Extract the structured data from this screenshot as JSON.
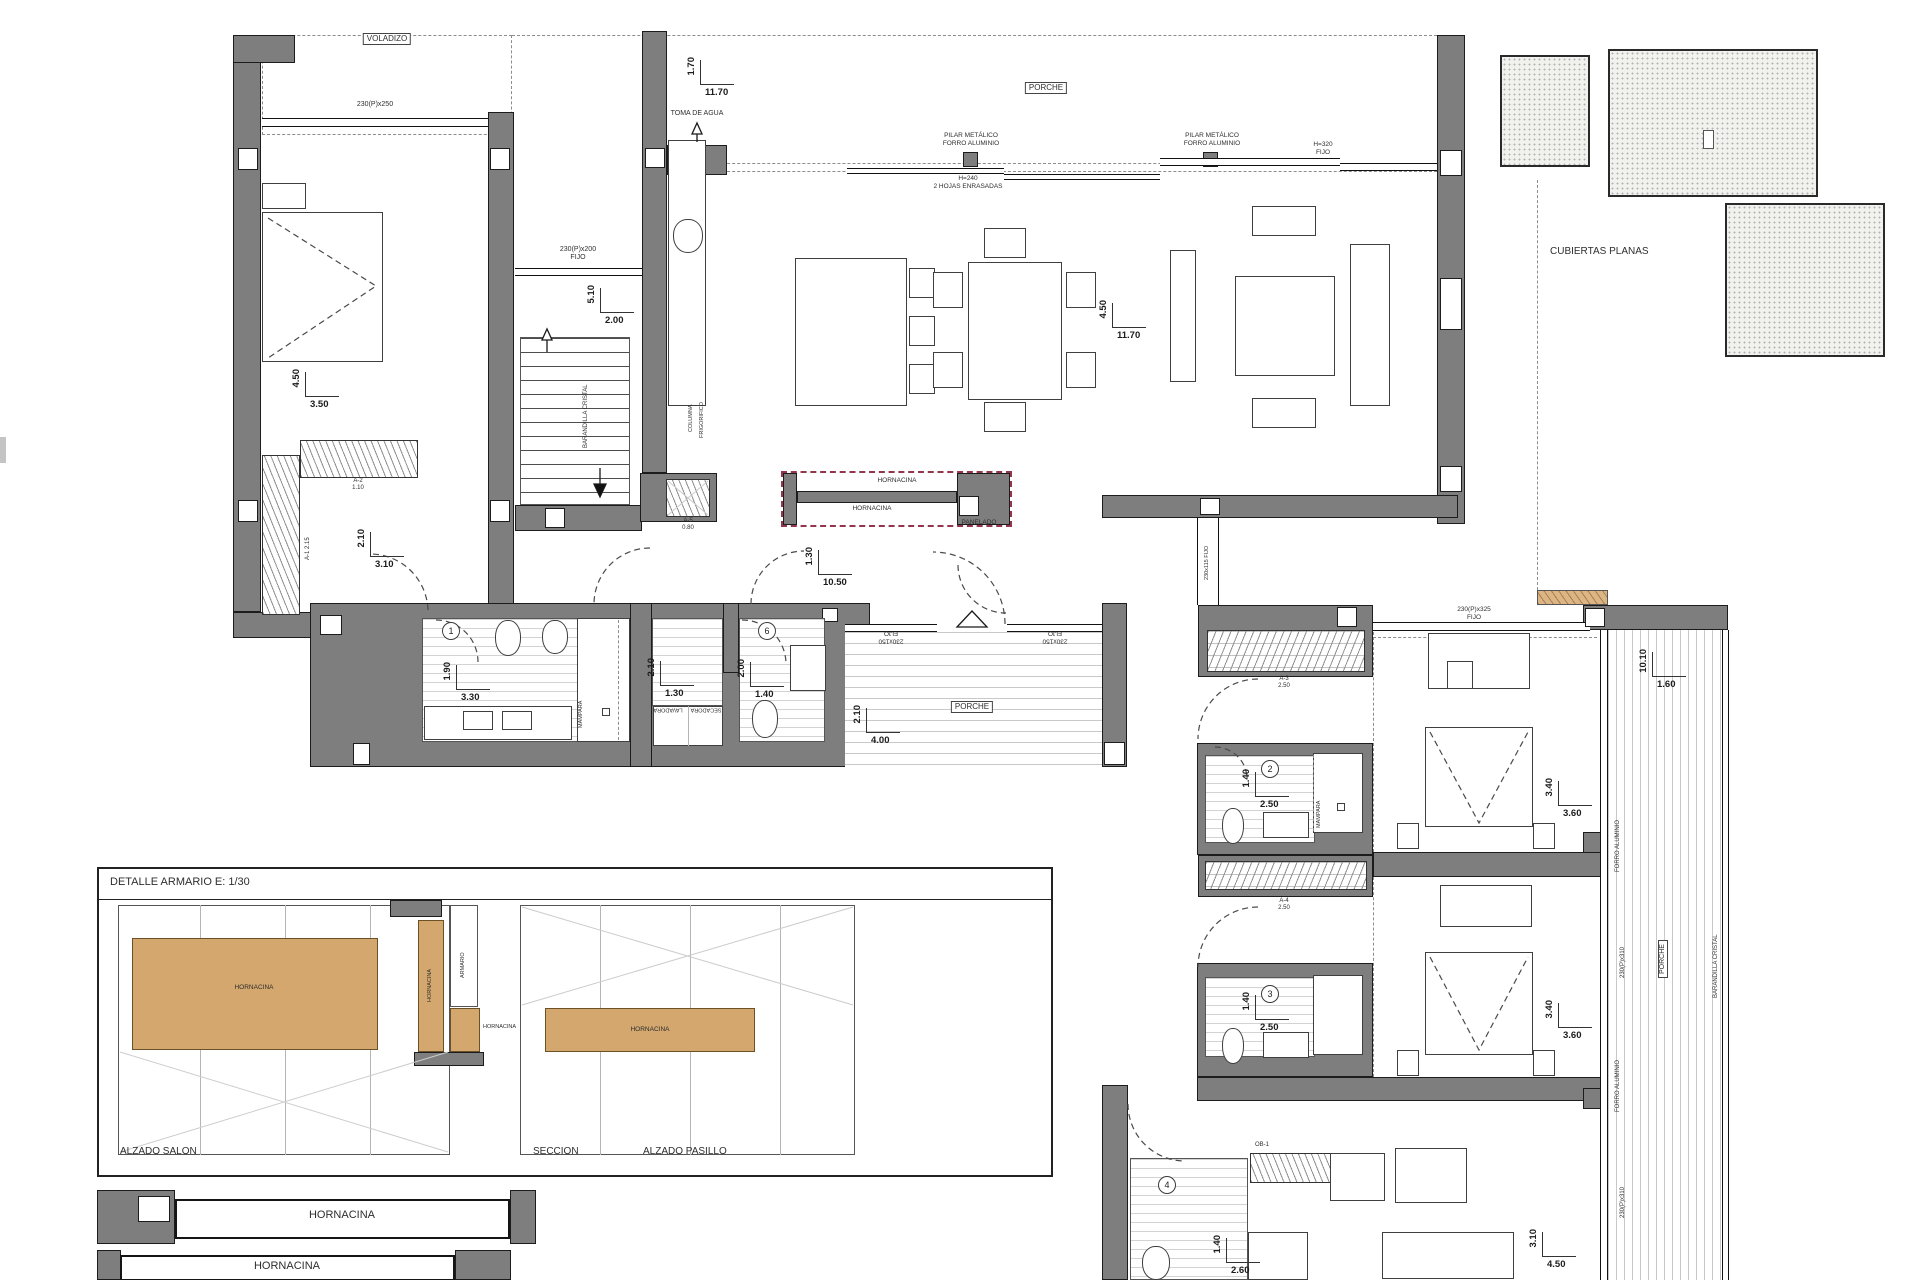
{
  "document": {
    "kind": "architectural floor plan (planta de vivienda) with roof inset and cabinet detail",
    "language": "es"
  },
  "colors": {
    "wall_fill": "#7e7e7e",
    "line": "#1c1c1c",
    "hornacina_highlight": "#93354c",
    "wood_panel": "#d3a76d",
    "stone_hatch": "#ddb584",
    "paper": "#ffffff"
  },
  "annotations": [
    {
      "id": "voladizo",
      "t": "VOLADIZO",
      "x": 387,
      "y": 33,
      "c": 1,
      "b": 1,
      "s": 8
    },
    {
      "id": "win-230p250",
      "t": "230(P)x250",
      "x": 375,
      "y": 101,
      "c": 1,
      "s": 7
    },
    {
      "id": "win-230p200",
      "t": "230(P)x200\nFIJO",
      "x": 578,
      "y": 246,
      "c": 1,
      "s": 7
    },
    {
      "id": "toma-de-agua",
      "t": "TOMA DE AGUA",
      "x": 697,
      "y": 110,
      "c": 1,
      "s": 7
    },
    {
      "id": "porche-top",
      "t": "PORCHE",
      "x": 1046,
      "y": 82,
      "c": 1,
      "b": 1,
      "s": 8
    },
    {
      "id": "pilar-metalico-1",
      "t": "PILAR METÁLICO\nFORRO ALUMINIO",
      "x": 971,
      "y": 132,
      "c": 1,
      "s": 6.5
    },
    {
      "id": "pilar-metalico-2",
      "t": "PILAR METÁLICO\nFORRO ALUMINIO",
      "x": 1212,
      "y": 132,
      "c": 1,
      "s": 6.5
    },
    {
      "id": "win-h320",
      "t": "H=320\nFIJO",
      "x": 1323,
      "y": 141,
      "c": 1,
      "s": 6.5
    },
    {
      "id": "win-h240",
      "t": "H=240\n2 HOJAS ENRASADAS",
      "x": 968,
      "y": 175,
      "c": 1,
      "s": 6.5
    },
    {
      "id": "hornacina-plan-top",
      "t": "HORNACINA",
      "x": 897,
      "y": 477,
      "c": 1,
      "s": 6.5
    },
    {
      "id": "hornacina-plan-bot",
      "t": "HORNACINA",
      "x": 872,
      "y": 505,
      "c": 1,
      "s": 6.5
    },
    {
      "id": "panelado",
      "t": "PANELADO",
      "x": 979,
      "y": 519,
      "c": 1,
      "s": 6.5
    },
    {
      "id": "armario-a5",
      "t": "A-5\n0.80",
      "x": 688,
      "y": 518,
      "c": 1,
      "s": 6
    },
    {
      "id": "armario-a2",
      "t": "A-2\n1.10",
      "x": 358,
      "y": 478,
      "c": 1,
      "s": 6
    },
    {
      "id": "armario-a1",
      "t": "A-1 2.15",
      "x": 305,
      "y": 560,
      "r": -90,
      "s": 6
    },
    {
      "id": "barandilla-escalera",
      "t": "BARANDILLA CRISTAL",
      "x": 583,
      "y": 448,
      "r": -90,
      "s": 6
    },
    {
      "id": "columna",
      "t": "COLUMNA",
      "x": 688,
      "y": 432,
      "r": -90,
      "s": 5.5
    },
    {
      "id": "frigorifico",
      "t": "FRIGORIFICO",
      "x": 699,
      "y": 438,
      "r": -90,
      "s": 5.5
    },
    {
      "id": "win-230x150-a",
      "t": "230x150\nFIJO",
      "x": 891,
      "y": 629,
      "c": 1,
      "r": 180,
      "s": 6.5
    },
    {
      "id": "win-230x150-b",
      "t": "230x150\nFIJO",
      "x": 1055,
      "y": 629,
      "c": 1,
      "r": 180,
      "s": 6.5
    },
    {
      "id": "porche-centro",
      "t": "PORCHE",
      "x": 972,
      "y": 701,
      "c": 1,
      "b": 1,
      "s": 8
    },
    {
      "id": "mampara-1",
      "t": "MAMPARA",
      "x": 578,
      "y": 728,
      "r": -90,
      "s": 5.5
    },
    {
      "id": "lavadora",
      "t": "LAVADORA",
      "x": 668,
      "y": 706,
      "c": 1,
      "r": 180,
      "s": 5.5
    },
    {
      "id": "secadora",
      "t": "SECADORA",
      "x": 706,
      "y": 706,
      "c": 1,
      "r": 180,
      "s": 5.5
    },
    {
      "id": "win-230x115",
      "t": "230x115 FIJO",
      "x": 1204,
      "y": 580,
      "r": -90,
      "s": 5.5
    },
    {
      "id": "armario-a3",
      "t": "A-3\n2.50",
      "x": 1284,
      "y": 676,
      "c": 1,
      "s": 6
    },
    {
      "id": "win-230p325",
      "t": "230(P)x325\nFIJO",
      "x": 1474,
      "y": 606,
      "c": 1,
      "s": 6.5
    },
    {
      "id": "mampara-2",
      "t": "MAMPARA",
      "x": 1316,
      "y": 828,
      "r": -90,
      "s": 5.5
    },
    {
      "id": "armario-a4",
      "t": "A-4\n2.50",
      "x": 1284,
      "y": 898,
      "c": 1,
      "s": 6
    },
    {
      "id": "forro-aluminio-1",
      "t": "FORRO ALUMINIO",
      "x": 1615,
      "y": 872,
      "r": -90,
      "s": 6
    },
    {
      "id": "forro-aluminio-2",
      "t": "FORRO ALUMINIO",
      "x": 1615,
      "y": 1112,
      "r": -90,
      "s": 6
    },
    {
      "id": "win-230p310-a",
      "t": "230(P)x310",
      "x": 1620,
      "y": 978,
      "r": -90,
      "s": 6
    },
    {
      "id": "win-230p310-b",
      "t": "230(P)x310",
      "x": 1620,
      "y": 1218,
      "r": -90,
      "s": 6
    },
    {
      "id": "porche-terraza",
      "t": "PORCHE",
      "x": 1658,
      "y": 978,
      "r": -90,
      "b": 1,
      "s": 7
    },
    {
      "id": "barandilla-terraza",
      "t": "BARANDILLA CRISTAL",
      "x": 1713,
      "y": 998,
      "r": -90,
      "s": 6
    },
    {
      "id": "cubiertas-planas",
      "t": "CUBIERTAS PLANAS",
      "x": 1550,
      "y": 246,
      "s": 10
    },
    {
      "id": "detalle-titulo",
      "t": "DETALLE ARMARIO E: 1/30",
      "x": 110,
      "y": 876,
      "s": 11
    },
    {
      "id": "hornacina-salon",
      "t": "HORNACINA",
      "x": 254,
      "y": 984,
      "c": 1,
      "s": 6.5
    },
    {
      "id": "hornacina-seccion-v",
      "t": "HORNACINA",
      "x": 427,
      "y": 1002,
      "r": -90,
      "s": 5.5
    },
    {
      "id": "armario-seccion",
      "t": "ARMARIO",
      "x": 460,
      "y": 978,
      "r": -90,
      "s": 5.5
    },
    {
      "id": "hornacina-seccion-s",
      "t": "HORNACINA",
      "x": 483,
      "y": 1024,
      "s": 5.5
    },
    {
      "id": "hornacina-pasillo",
      "t": "HORNACINA",
      "x": 650,
      "y": 1026,
      "c": 1,
      "s": 6.5
    },
    {
      "id": "alzado-salon",
      "t": "ALZADO SALON",
      "x": 120,
      "y": 1146,
      "s": 10
    },
    {
      "id": "seccion",
      "t": "SECCION",
      "x": 533,
      "y": 1146,
      "s": 10
    },
    {
      "id": "alzado-pasillo",
      "t": "ALZADO PASILLO",
      "x": 643,
      "y": 1146,
      "s": 10
    },
    {
      "id": "hornacina-bar1",
      "t": "HORNACINA",
      "x": 342,
      "y": 1209,
      "c": 1,
      "s": 11
    },
    {
      "id": "hornacina-bar2",
      "t": "HORNACINA",
      "x": 287,
      "y": 1260,
      "c": 1,
      "s": 11
    },
    {
      "id": "ob1",
      "t": "OB-1",
      "x": 1262,
      "y": 1142,
      "c": 1,
      "s": 6
    }
  ],
  "dimensions": [
    {
      "v": "1.70",
      "h": "11.70",
      "x": 700,
      "y": 60
    },
    {
      "v": "5.10",
      "h": "2.00",
      "x": 600,
      "y": 288
    },
    {
      "v": "4.50",
      "h": "3.50",
      "x": 305,
      "y": 372
    },
    {
      "v": "2.10",
      "h": "3.10",
      "x": 370,
      "y": 532
    },
    {
      "v": "4.50",
      "h": "11.70",
      "x": 1112,
      "y": 303
    },
    {
      "v": "1.30",
      "h": "10.50",
      "x": 818,
      "y": 550
    },
    {
      "v": "1.90",
      "h": "3.30",
      "x": 456,
      "y": 665
    },
    {
      "v": "2.10",
      "h": "1.30",
      "x": 660,
      "y": 661
    },
    {
      "v": "2.00",
      "h": "1.40",
      "x": 750,
      "y": 662
    },
    {
      "v": "2.10",
      "h": "4.00",
      "x": 866,
      "y": 708
    },
    {
      "v": "3.40",
      "h": "3.60",
      "x": 1558,
      "y": 781
    },
    {
      "v": "1.40",
      "h": "2.50",
      "x": 1255,
      "y": 772
    },
    {
      "v": "3.40",
      "h": "3.60",
      "x": 1558,
      "y": 1003
    },
    {
      "v": "1.40",
      "h": "2.50",
      "x": 1255,
      "y": 995
    },
    {
      "v": "10.10",
      "h": "1.60",
      "x": 1652,
      "y": 652
    },
    {
      "v": "1.40",
      "h": "2.60",
      "x": 1226,
      "y": 1238
    },
    {
      "v": "3.10",
      "h": "4.50",
      "x": 1542,
      "y": 1232
    }
  ],
  "room_circles": [
    {
      "n": "1",
      "x": 442,
      "y": 622
    },
    {
      "n": "6",
      "x": 758,
      "y": 622
    },
    {
      "n": "2",
      "x": 1261,
      "y": 760
    },
    {
      "n": "3",
      "x": 1261,
      "y": 985
    },
    {
      "n": "4",
      "x": 1158,
      "y": 1176
    }
  ]
}
